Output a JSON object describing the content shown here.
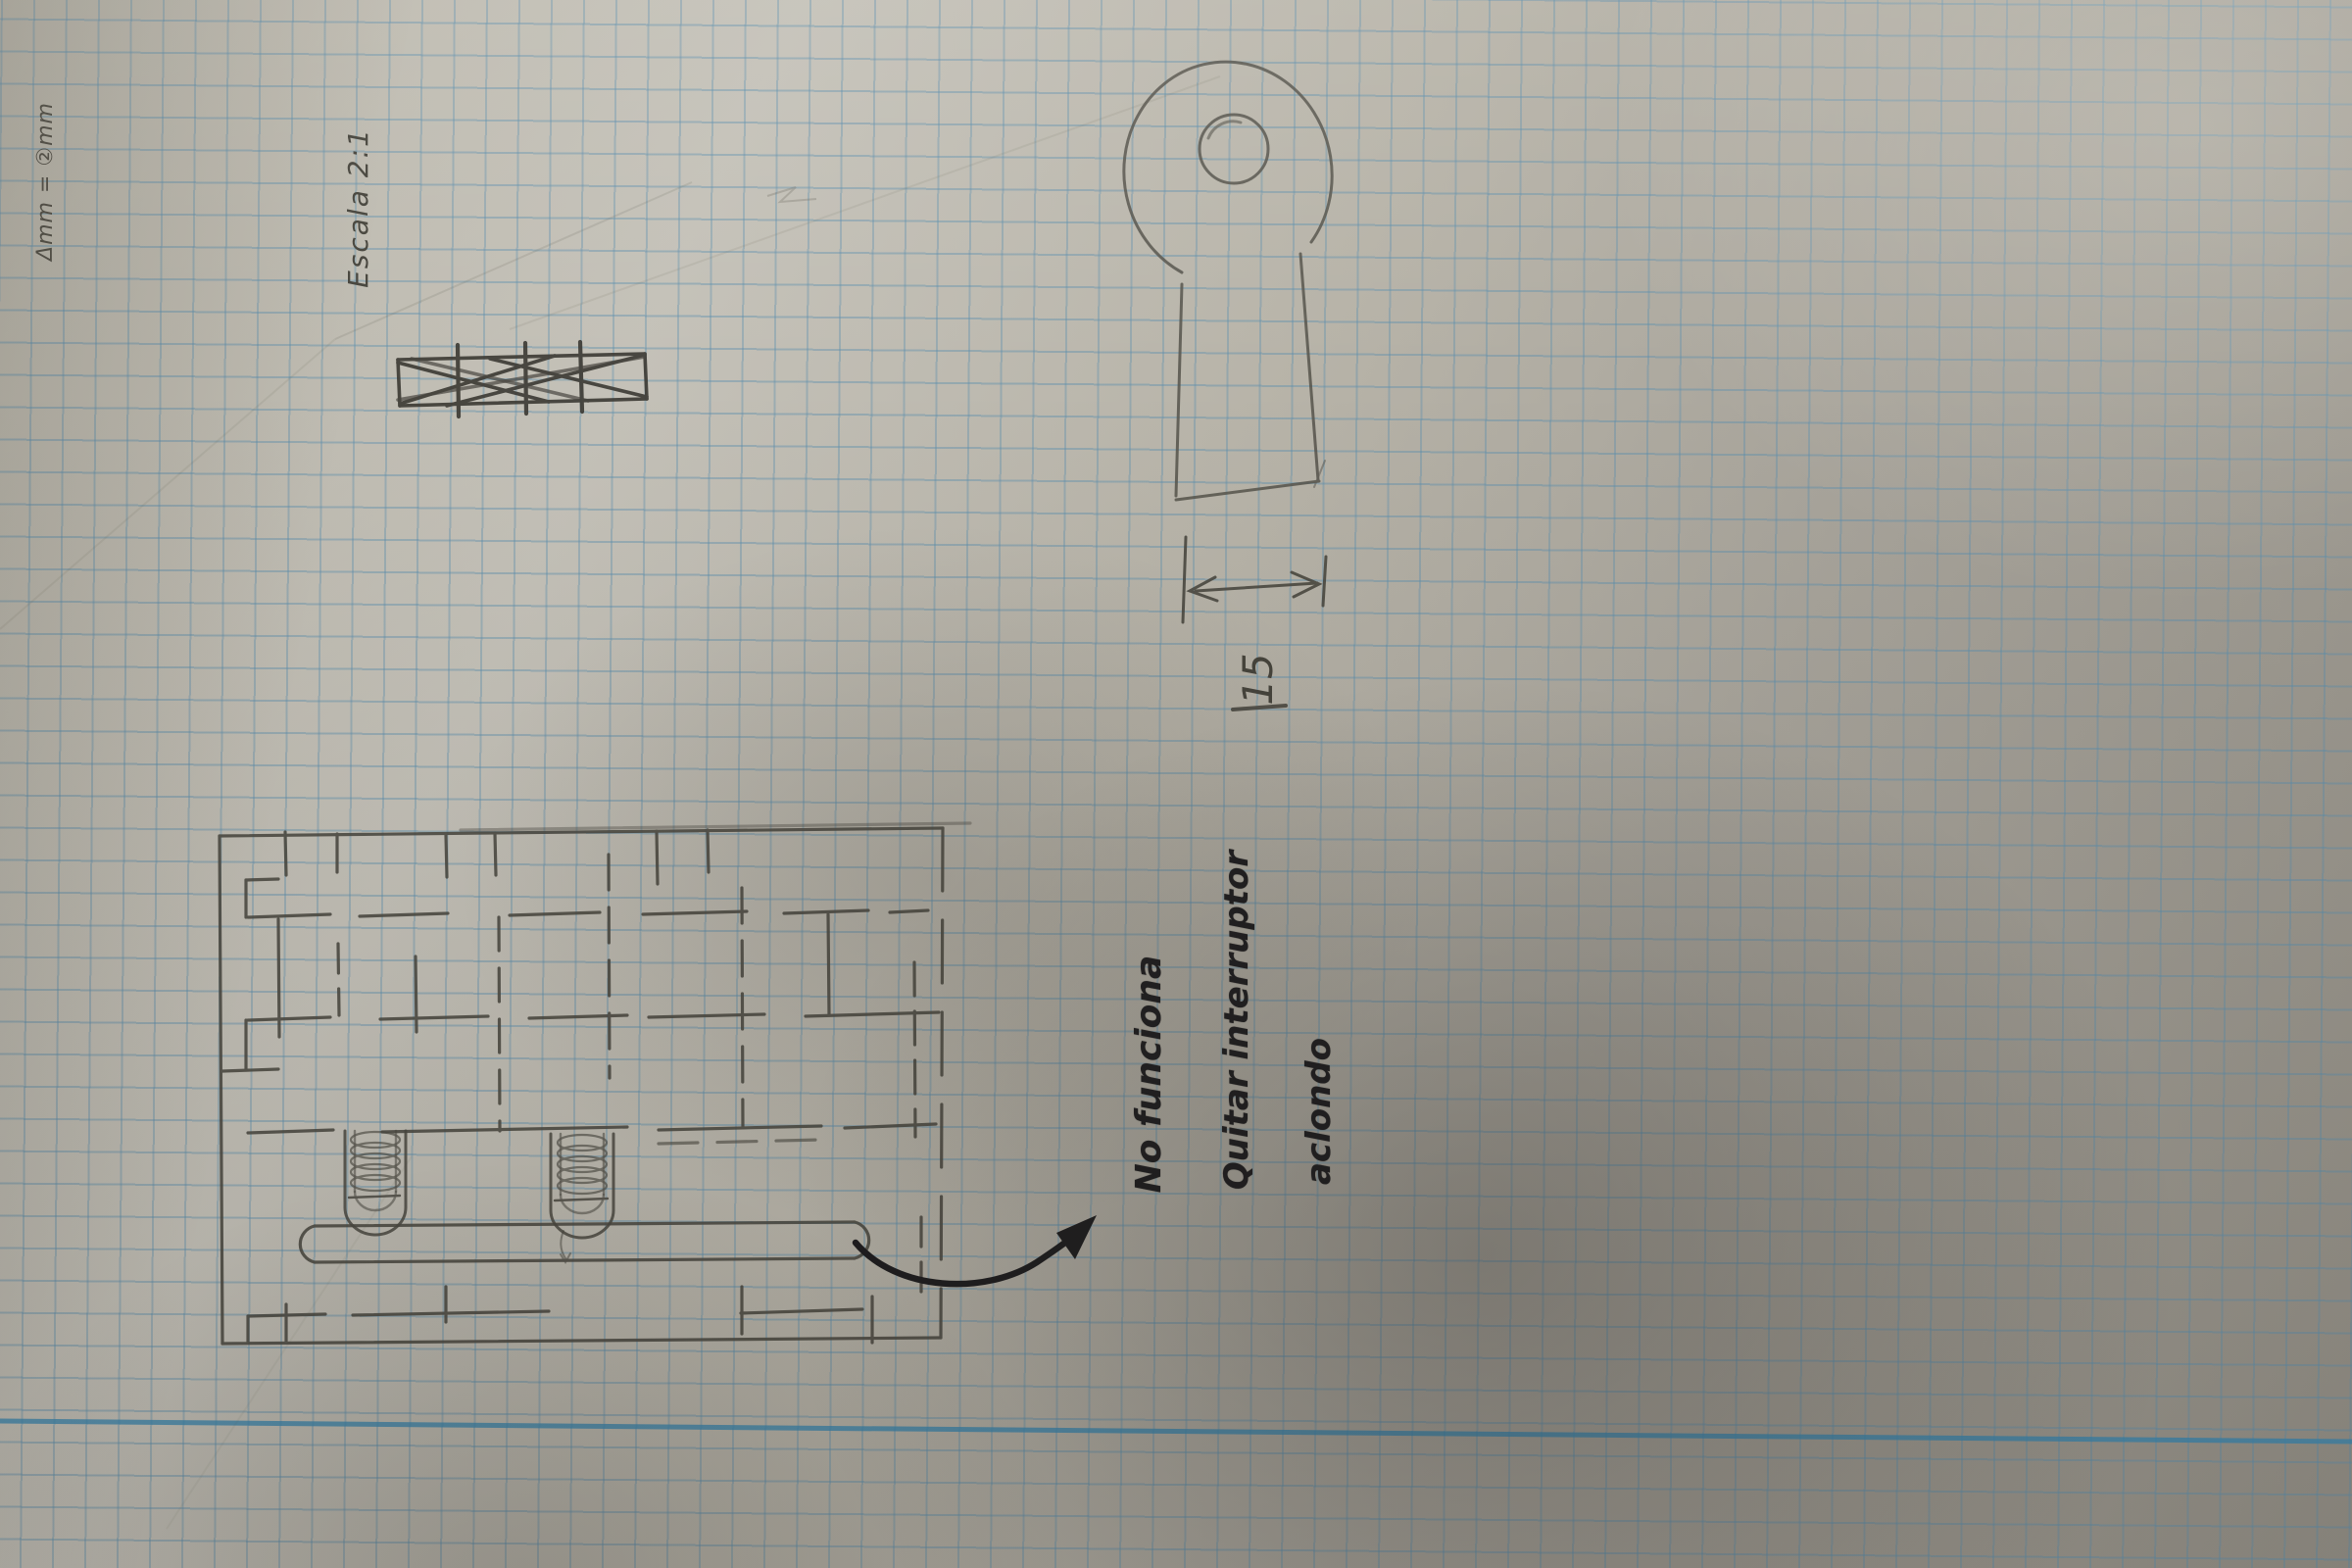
{
  "annotations": {
    "corner_note": "Δmm = ②mm",
    "scale_note": "Escala 2:1",
    "dimension_value": "15",
    "repair_note_line1": "No funciona",
    "repair_note_line2": "Quitar interruptor",
    "repair_note_line3": "aclondo"
  },
  "colors": {
    "paper": "#b8b4a8",
    "grid_line": "#5c8eac",
    "margin_rule": "#3a86af",
    "pencil": "#4a4840",
    "ink": "#1d1c1e"
  }
}
